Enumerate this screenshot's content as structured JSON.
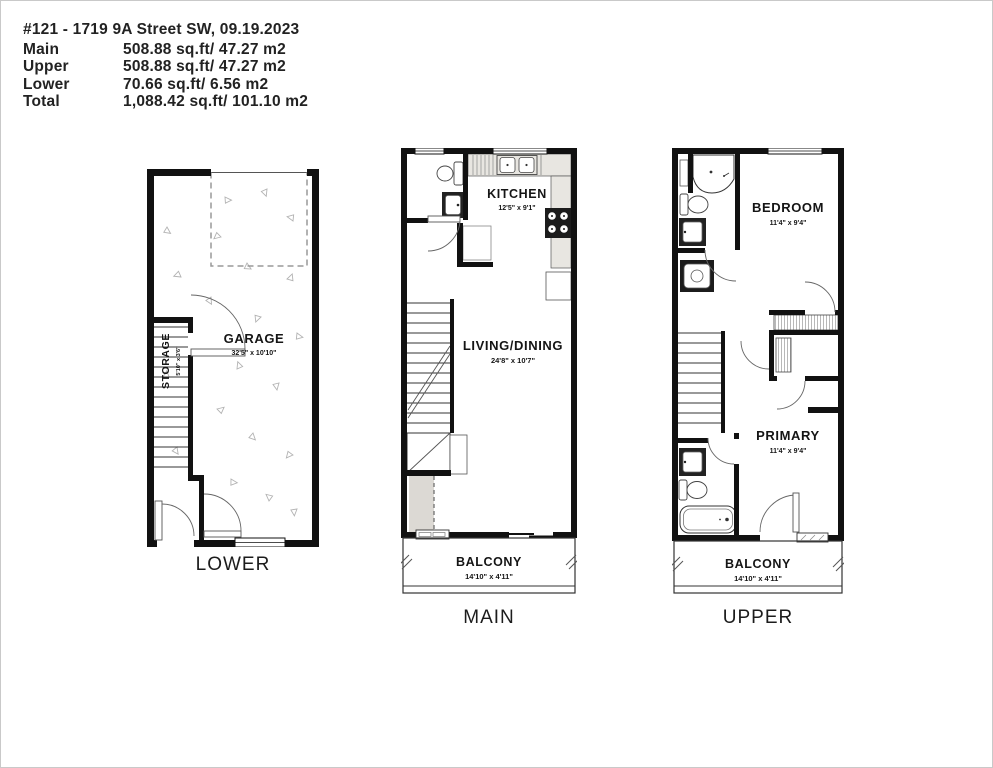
{
  "header": {
    "title": "#121 - 1719 9A Street SW, 09.19.2023",
    "rows": [
      {
        "label": "Main",
        "value": "508.88 sq.ft/ 47.27 m2"
      },
      {
        "label": "Upper",
        "value": "508.88 sq.ft/ 47.27 m2"
      },
      {
        "label": "Lower",
        "value": "70.66 sq.ft/ 6.56 m2"
      },
      {
        "label": "Total",
        "value": "1,088.42 sq.ft/ 101.10 m2"
      }
    ]
  },
  "floors": {
    "lower": {
      "caption": "LOWER",
      "garage": {
        "name": "GARAGE",
        "dims": "32'5\" x 10'10\""
      },
      "storage": {
        "name": "STORAGE",
        "dims": "5'10\" x 3'6\""
      }
    },
    "main": {
      "caption": "MAIN",
      "kitchen": {
        "name": "KITCHEN",
        "dims": "12'5\" x 9'1\""
      },
      "living": {
        "name": "LIVING/DINING",
        "dims": "24'8\" x 10'7\""
      },
      "balcony": {
        "name": "BALCONY",
        "dims": "14'10\" x 4'11\""
      }
    },
    "upper": {
      "caption": "UPPER",
      "bedroom": {
        "name": "BEDROOM",
        "dims": "11'4\" x 9'4\""
      },
      "primary": {
        "name": "PRIMARY",
        "dims": "11'4\" x 9'4\""
      },
      "balcony": {
        "name": "BALCONY",
        "dims": "14'10\" x 4'11\""
      }
    }
  },
  "colors": {
    "wall": "#111111",
    "counter": "#e8e6e1",
    "shade": "#dcd9d4"
  }
}
